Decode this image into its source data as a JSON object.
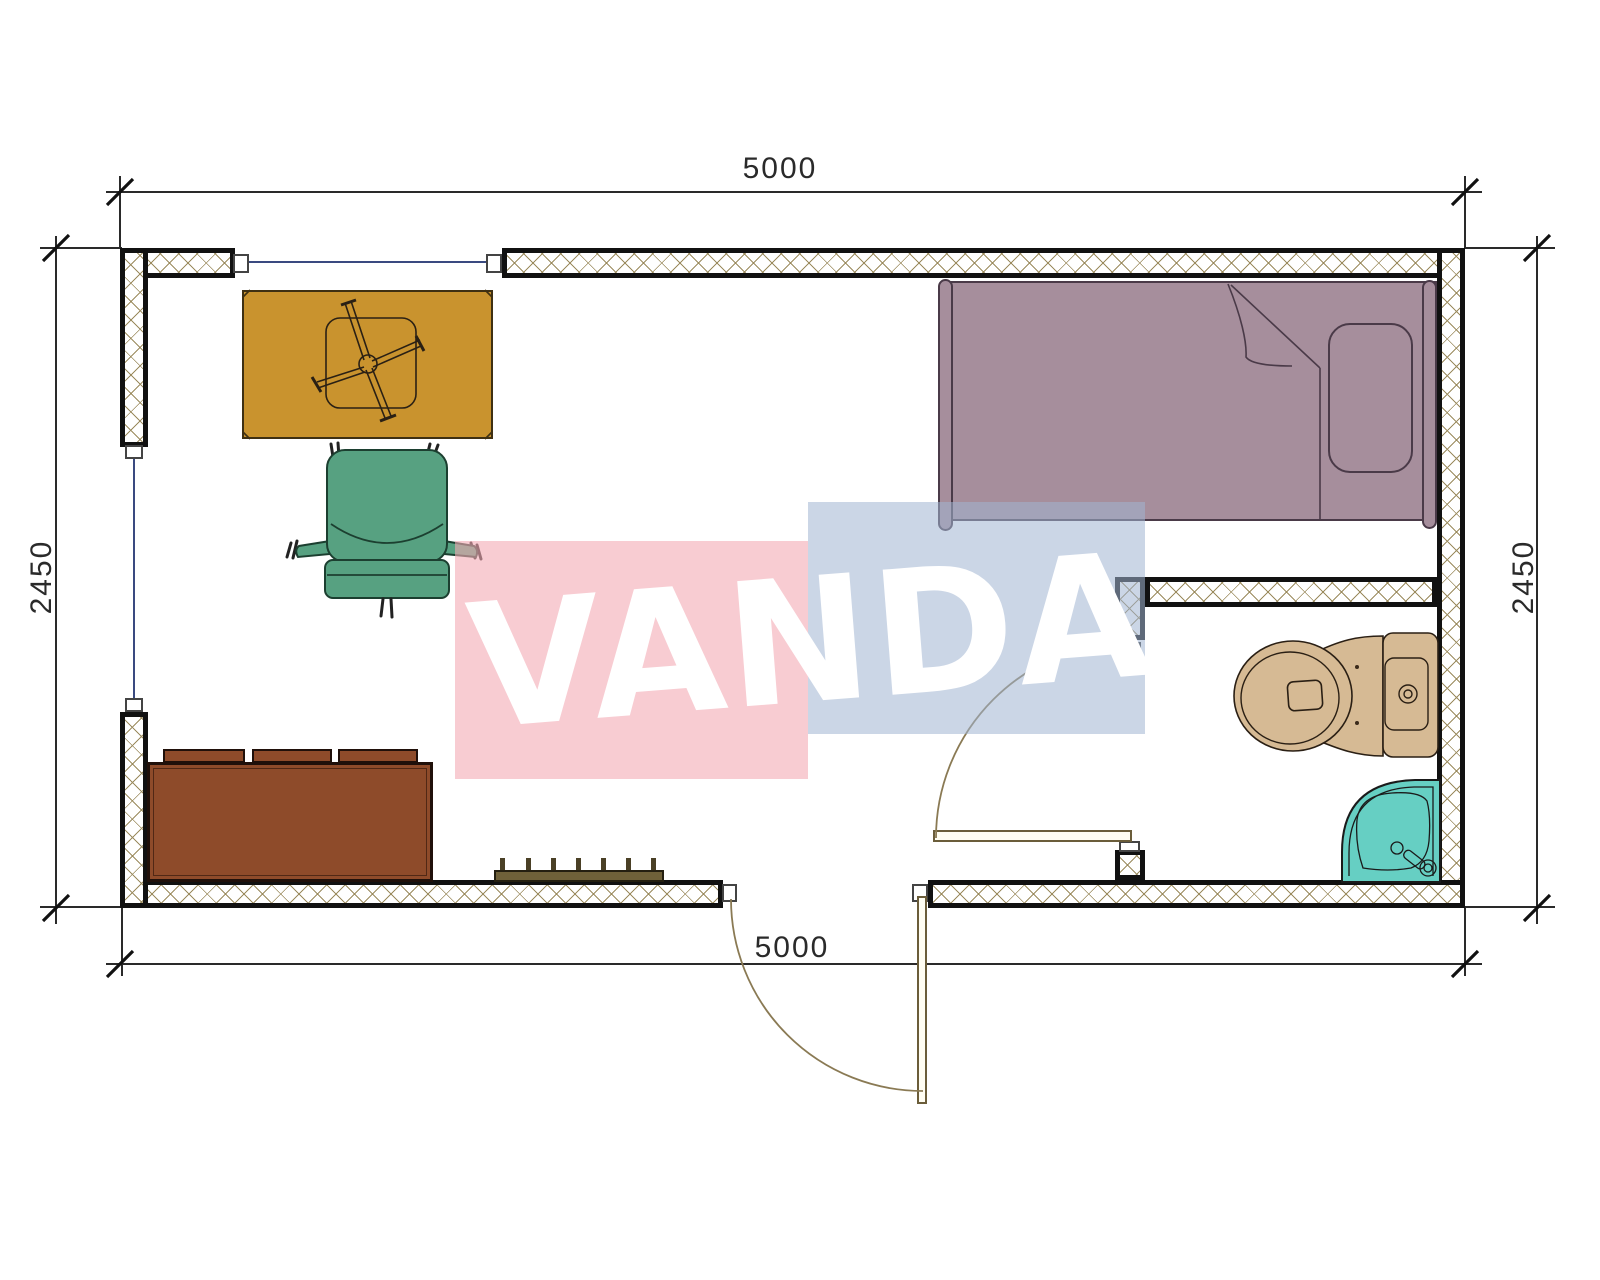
{
  "page": {
    "type": "architectural floor plan drawing",
    "background": "#ffffff"
  },
  "dimensions": {
    "top_width": "5000",
    "bottom_width": "5000",
    "left_height": "2450",
    "right_height": "2450"
  },
  "watermark": {
    "text": "VANDA"
  },
  "furniture_icons": [
    "desk-icon",
    "chair-base-icon",
    "office-chair-icon",
    "sofa-icon",
    "radiator-icon",
    "bed-icon",
    "pillow-icon",
    "toilet-icon",
    "shower-icon",
    "door-swing-icon",
    "window-icon"
  ],
  "colors": {
    "wall_hatch": "#9b8b5e",
    "wall_border": "#111111",
    "window_line": "#3a4a80",
    "desk": "#c9932e",
    "chair": "#57a181",
    "sofa": "#8e4b2a",
    "radiator": "#6f6139",
    "bed": "#a68e9c",
    "toilet": "#d6ba94",
    "shower": "#66cfc3",
    "watermark_pink": "rgba(244,170,180,0.6)",
    "watermark_blue": "rgba(160,180,210,0.55)",
    "watermark_text": "#ffffff",
    "dim": "#2a2a2a",
    "arc": "#8a7a54"
  }
}
